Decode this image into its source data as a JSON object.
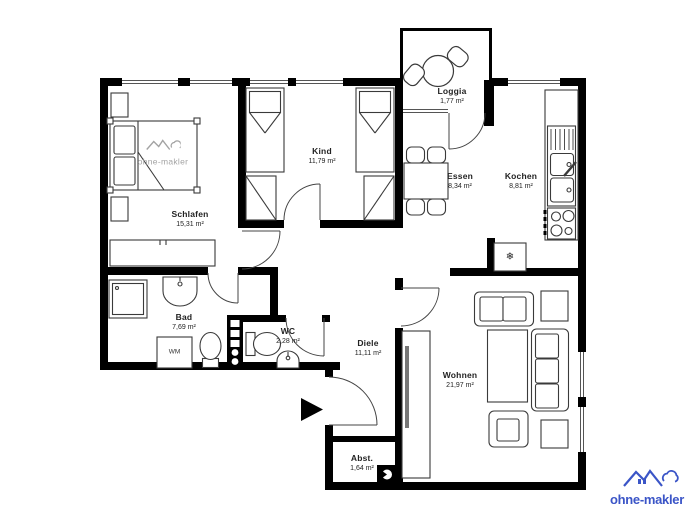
{
  "rooms": [
    {
      "name": "Schlafen",
      "area": "15,31 m²"
    },
    {
      "name": "Kind",
      "area": "11,79 m²"
    },
    {
      "name": "Loggia",
      "area": "1,77 m²"
    },
    {
      "name": "Essen",
      "area": "8,34 m²"
    },
    {
      "name": "Kochen",
      "area": "8,81 m²"
    },
    {
      "name": "Bad",
      "area": "7,69 m²"
    },
    {
      "name": "WC",
      "area": "2,28 m²"
    },
    {
      "name": "Diele",
      "area": "11,11 m²"
    },
    {
      "name": "Wohnen",
      "area": "21,97 m²"
    },
    {
      "name": "Abst.",
      "area": "1,64 m²"
    }
  ],
  "appliances": {
    "washing_machine_label": "WM",
    "freezer_glyph": "❄"
  },
  "branding": {
    "watermark_text": "ohne-makler",
    "logo_text": "ohne-makler",
    "logo_color": "#3b55c7"
  },
  "colors": {
    "walls": "#000000",
    "furniture_outline": "#3a3a3a",
    "label_text": "#222222",
    "watermark_gray": "#a3a3a3"
  }
}
